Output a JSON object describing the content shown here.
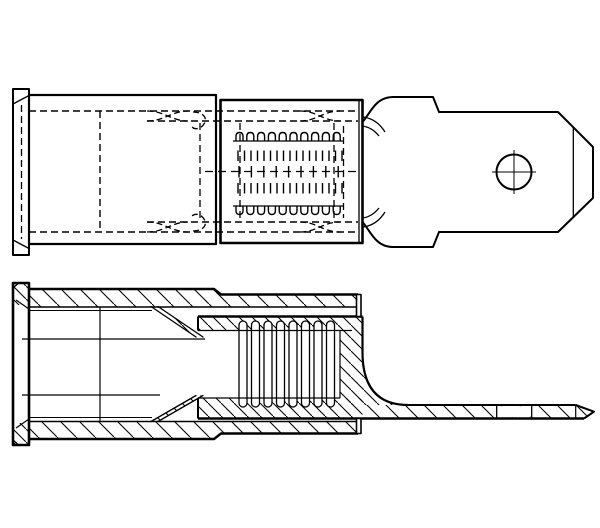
{
  "colors": {
    "paper": "#ffffff",
    "ink": "#000000"
  },
  "figure": {
    "kind": "technical-line-drawing",
    "subject": "Insulated male quick-disconnect crimp terminal, two orthographic views",
    "views": [
      {
        "name": "plan-view",
        "description": "External top view, hidden detail dashed",
        "features": [
          "flared-insulation-entry-flange",
          "insulation-sleeve",
          "hidden-wire-barrel-dashed",
          "serrated-insulation-crimp-zone",
          "transition-neck",
          "male-tab-blade",
          "detent-dimple-with-centerlines",
          "chamfered-blade-tip"
        ]
      },
      {
        "name": "section-view",
        "description": "Longitudinal cross-section, cut material hatched",
        "features": [
          "hatched-insulation-sleeve",
          "entry-flange-with-flare",
          "inner-metal-wire-barrel",
          "serration-ribs",
          "funnel-wire-guide",
          "fillet-transition",
          "tab-blade-section",
          "dimple-gap",
          "chamfered-tip"
        ]
      }
    ]
  }
}
